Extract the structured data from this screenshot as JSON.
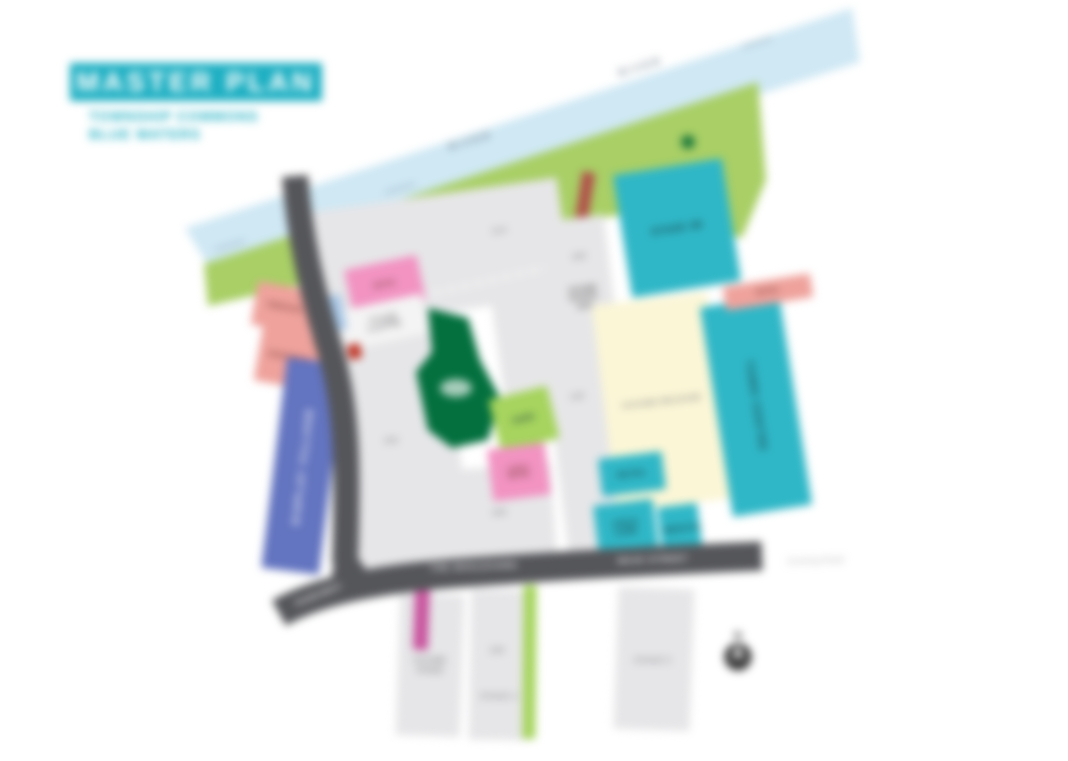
{
  "title": {
    "label": "MASTER PLAN",
    "subtitle1": "TOWNSHIP COMMONS",
    "subtitle2": "BLUE WATERS"
  },
  "river": {
    "label1": "RIVER",
    "label2": "RIVER"
  },
  "roads": {
    "boulevard": "THE BOULEVARD",
    "main": "MAIN STREET",
    "entry": "PARKWAY",
    "existing_note": "Existing Road"
  },
  "parcels": {
    "stage2b": "STAGE 2B",
    "future": "FUTURE RELEASE",
    "town_centre": "TOWN CENTRE",
    "retail_strip": "RETAIL",
    "retail_box": "RETAIL",
    "childcare": "CHILD CARE",
    "medical": "MEDICAL",
    "pink_retail": "RETAIL",
    "sales": "SALES CENTRE",
    "terrace_a": "TERRACES",
    "terrace_b": "APARTMENTS",
    "display_village": "DISPLAY VILLAGE",
    "park": "PARK",
    "plaza": "LOCAL RETAIL",
    "school_site": "FUTURE SCHOOL SITE",
    "bottom_a": "FUTURE STAGE",
    "bottom_b_num": "220",
    "bottom_b": "STAGE 4",
    "bottom_c": "STAGE 5"
  },
  "lots": {
    "a": "214",
    "b": "218",
    "c": "302",
    "d": "306",
    "e": "300",
    "f": "105"
  },
  "compass": {
    "label": "N"
  },
  "colors": {
    "teal": "#1fb0c3",
    "cyan": "#2fb7c7",
    "cream": "#fbf6d6",
    "salmon": "#efa29c",
    "blue": "#6374c0",
    "pink": "#f293c2",
    "magenta": "#c9579f",
    "lime": "#a6d45e",
    "dark_green": "#03703e",
    "park_green": "#a9cf66",
    "river_blue": "#cfe8f4",
    "road_gray": "#55565a",
    "lot_gray": "#e6e6e8"
  }
}
